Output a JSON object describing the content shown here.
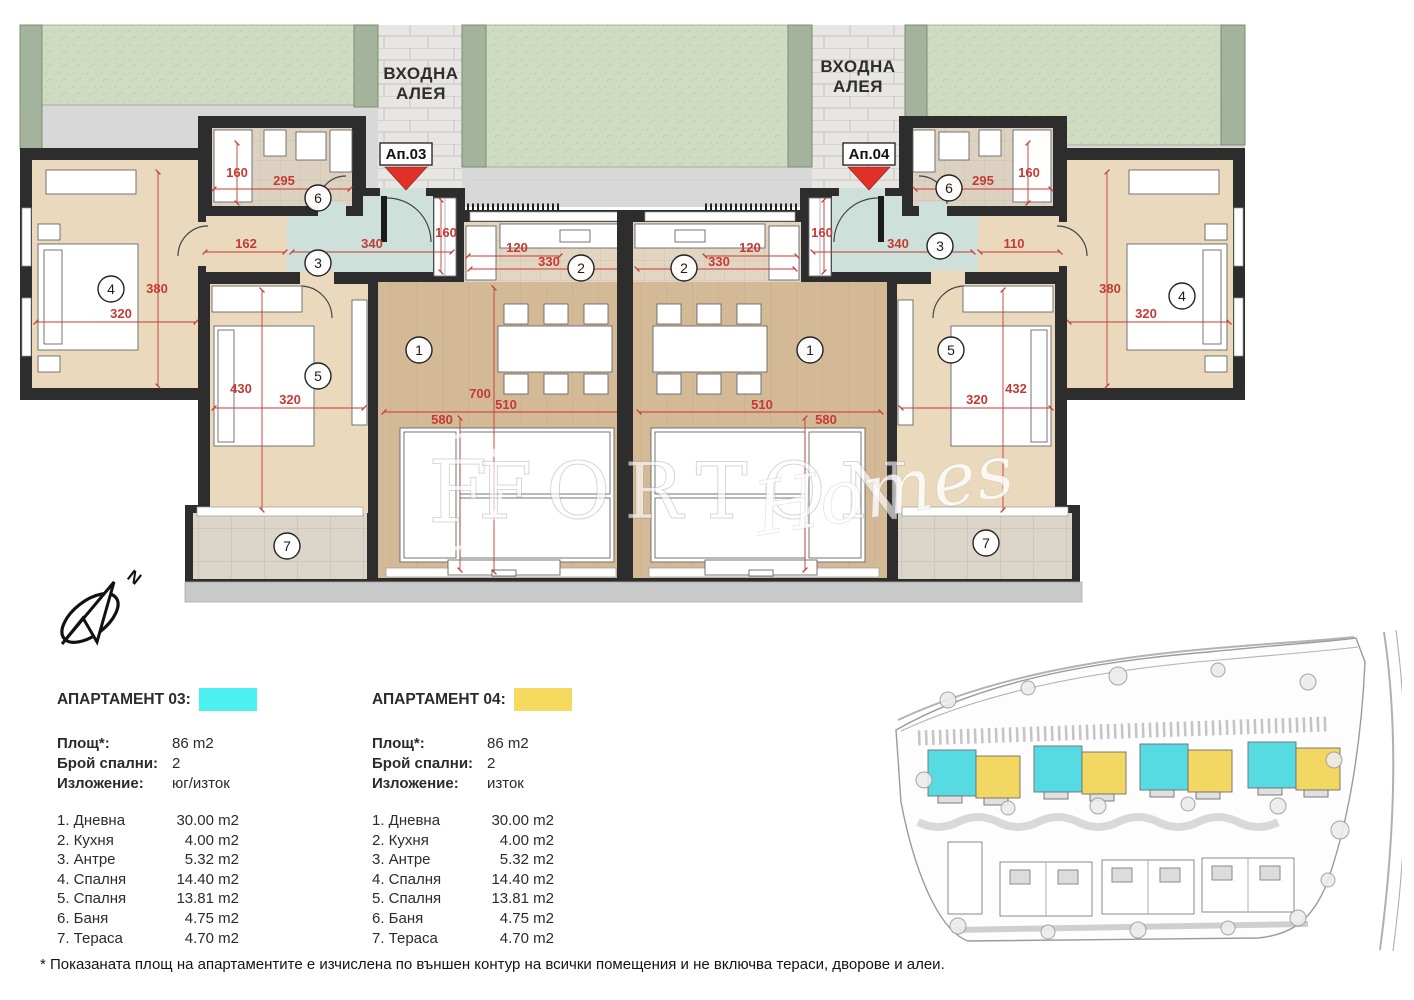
{
  "plan": {
    "entrance": {
      "line1": "ВХОДНА",
      "line2": "АЛЕЯ"
    },
    "apt_markers": {
      "left": "Ап.03",
      "right": "Ап.04"
    },
    "circles": [
      "1",
      "2",
      "3",
      "4",
      "5",
      "6",
      "7"
    ],
    "dims_left": [
      "160",
      "295",
      "162",
      "340",
      "160",
      "120",
      "330",
      "380",
      "320",
      "430",
      "320",
      "700",
      "510",
      "580"
    ],
    "dims_right": [
      "160",
      "295",
      "110",
      "340",
      "160",
      "120",
      "330",
      "380",
      "320",
      "432",
      "320",
      "510",
      "580"
    ],
    "watermark": {
      "monogram": "F",
      "serif": "FORTON",
      "script": "Homes"
    },
    "compass_north": "N"
  },
  "legend": {
    "apartments": [
      {
        "title": "АПАРТАМЕНТ 03:",
        "swatch_color": "#4DF0F0",
        "info": [
          {
            "label": "Площ*:",
            "value": "86 m2"
          },
          {
            "label": "Брой спални:",
            "value": "2"
          },
          {
            "label": "Изложение:",
            "value": "юг/изток"
          }
        ],
        "rooms": [
          {
            "name": "1. Дневна",
            "area": "30.00 m2"
          },
          {
            "name": "2. Кухня",
            "area": "4.00 m2"
          },
          {
            "name": "3. Антре",
            "area": "5.32 m2"
          },
          {
            "name": "4. Спалня",
            "area": "14.40 m2"
          },
          {
            "name": "5. Спалня",
            "area": "13.81 m2"
          },
          {
            "name": "6. Баня",
            "area": "4.75 m2"
          },
          {
            "name": "7. Тераса",
            "area": "4.70 m2"
          }
        ]
      },
      {
        "title": "АПАРТАМЕНТ 04:",
        "swatch_color": "#F6D95F",
        "info": [
          {
            "label": "Площ*:",
            "value": "86 m2"
          },
          {
            "label": "Брой спални:",
            "value": "2"
          },
          {
            "label": "Изложение:",
            "value": "изток"
          }
        ],
        "rooms": [
          {
            "name": "1. Дневна",
            "area": "30.00 m2"
          },
          {
            "name": "2. Кухня",
            "area": "4.00 m2"
          },
          {
            "name": "3. Антре",
            "area": "5.32 m2"
          },
          {
            "name": "4. Спалня",
            "area": "14.40 m2"
          },
          {
            "name": "5. Спалня",
            "area": "13.81 m2"
          },
          {
            "name": "6. Баня",
            "area": "4.75 m2"
          },
          {
            "name": "7. Тераса",
            "area": "4.70 m2"
          }
        ]
      }
    ]
  },
  "footnote": "* Показаната площ на апартаментите е изчислена по външен контур на всички помещения и не включва тераси, дворове и алеи.",
  "colors": {
    "apt3_highlight": "#4DF0F0",
    "apt4_highlight": "#F6D95F",
    "dimension_red": "#C43A35",
    "hall_teal": "#CDE0D9",
    "living_wood": "#D4B997",
    "bedroom_beige": "#EAD9BD",
    "wall_black": "#2D2D2D",
    "grass_green": "#CFDCC1",
    "hedge_green": "#A4B39B"
  }
}
